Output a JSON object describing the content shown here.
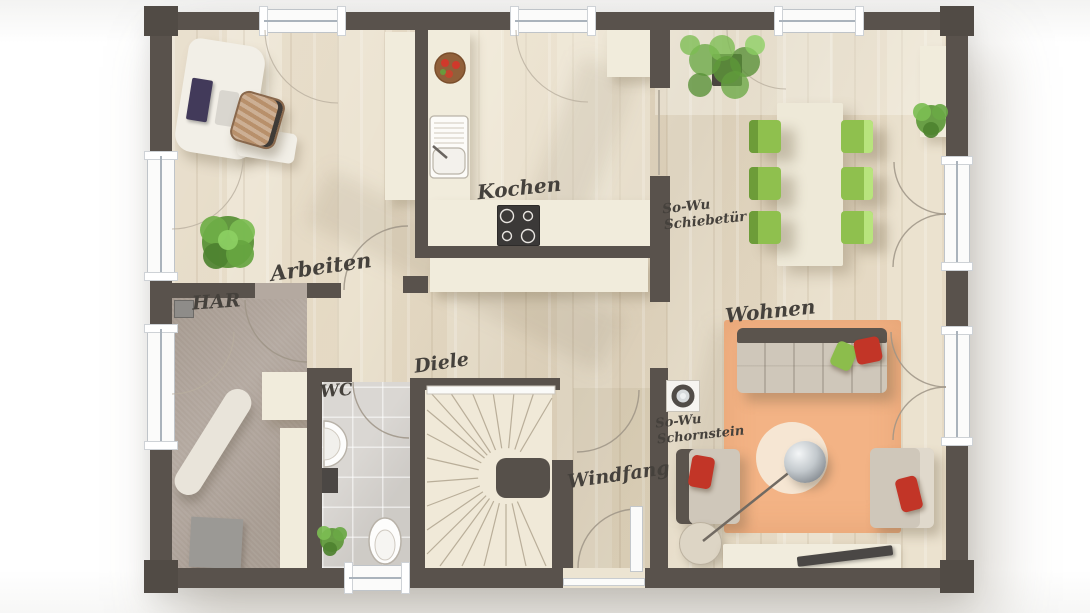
{
  "floorplan": {
    "rooms": [
      {
        "id": "arbeiten",
        "label": "Arbeiten"
      },
      {
        "id": "kochen",
        "label": "Kochen"
      },
      {
        "id": "har",
        "label": "HAR"
      },
      {
        "id": "wc",
        "label": "WC"
      },
      {
        "id": "diele",
        "label": "Diele"
      },
      {
        "id": "windfang",
        "label": "Windfang"
      },
      {
        "id": "wohnen",
        "label": "Wohnen"
      }
    ],
    "annotations": [
      {
        "id": "schiebetuer",
        "lines": [
          "So-Wu",
          "Schiebetür"
        ]
      },
      {
        "id": "schornstein",
        "lines": [
          "So-Wu",
          "Schornstein"
        ]
      }
    ],
    "objects": [
      "desk",
      "office-chair",
      "plant",
      "tall-cabinet",
      "kitchen-counter",
      "sink",
      "fruit-bowl",
      "stove",
      "sideboard",
      "dining-table",
      "dining-chairs",
      "french-doors",
      "sofa",
      "pillows",
      "coffee-table",
      "arc-lamp",
      "armchairs",
      "tv-lowboard",
      "rug",
      "winder-stairs",
      "ironing-board",
      "floor-mat",
      "wc-sink",
      "toilet",
      "chimney",
      "entry-door"
    ],
    "colors": {
      "wall": "#59524c",
      "floor_wood": "#ebe2cf",
      "floor_carpet_har": "#b4a9a0",
      "floor_tile_wc": "#dad7d3",
      "rug_wohnen": "#f3b385",
      "chair_green": "#8fc04e",
      "accent_red": "#c23527",
      "sofa_beige": "#cfc7ba",
      "counter_cream": "#f1ecdc",
      "label_text": "#45413c"
    }
  }
}
